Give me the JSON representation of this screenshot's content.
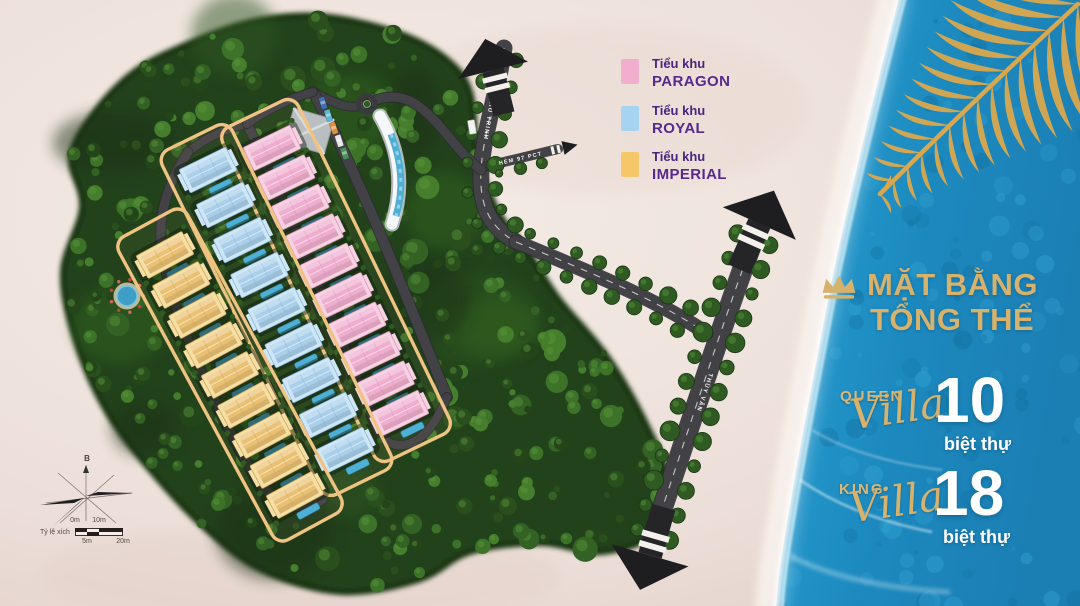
{
  "legend": {
    "items": [
      {
        "group": "Tiểu khu",
        "name": "PARAGON",
        "color": "#F2AECD"
      },
      {
        "group": "Tiểu khu",
        "name": "ROYAL",
        "color": "#A5D3F0"
      },
      {
        "group": "Tiểu khu",
        "name": "IMPERIAL",
        "color": "#F5C769"
      }
    ]
  },
  "panel": {
    "title_line1": "MẶT BẰNG",
    "title_line2": "TỔNG THỂ",
    "stats": [
      {
        "tier": "QUEEN",
        "script_word": "Villa",
        "count": "10",
        "unit": "biệt thự"
      },
      {
        "tier": "KING",
        "script_word": "Villa",
        "count": "18",
        "unit": "biệt thự"
      }
    ]
  },
  "map": {
    "roads": [
      {
        "name": "PHAN CHU TRINH"
      },
      {
        "name": "HẺM 97 PCT"
      },
      {
        "name": "THÙY VÂN"
      }
    ],
    "subdivisions": [
      {
        "name": "PARAGON",
        "villa_count": 10,
        "roof": "#EFAECE",
        "wall": "#F7D2E3",
        "accent": "#D78FB5"
      },
      {
        "name": "ROYAL",
        "villa_count": 9,
        "roof": "#A9CFEA",
        "wall": "#CFE6F6",
        "accent": "#7FB0D6"
      },
      {
        "name": "IMPERIAL",
        "villa_count": 9,
        "roof": "#EAC173",
        "wall": "#F4DFA6",
        "accent": "#CE9E4B"
      }
    ],
    "compass_north_label": "B",
    "scale": {
      "label": "Tỷ lệ xích",
      "ticks_top": [
        "0m",
        "10m"
      ],
      "ticks_bottom": [
        "5m",
        "20m"
      ]
    }
  },
  "colors": {
    "gold": "#D6B26C",
    "sea": "#1C89BE",
    "sand": "#EDE0DA",
    "land": "#24421B",
    "road": "#3A3A3E",
    "boundary": "#EFC382",
    "text_purple": "#57298C"
  }
}
